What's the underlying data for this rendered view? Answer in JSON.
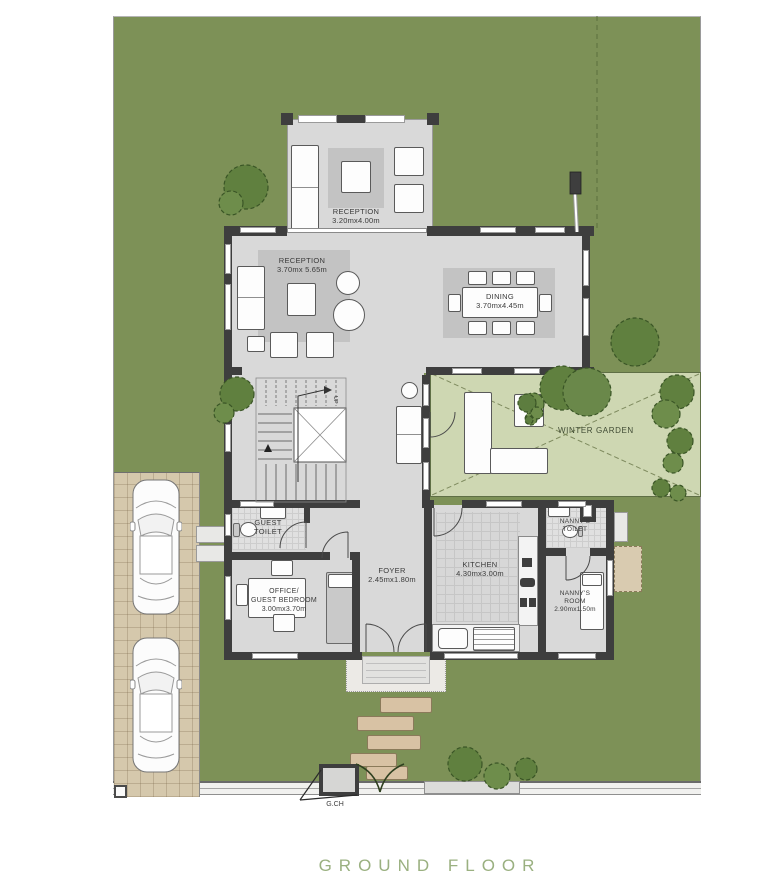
{
  "footer": {
    "title": "GROUND FLOOR"
  },
  "rooms": {
    "reception_terrace": {
      "name": "RECEPTION",
      "size": "3.20mx4.00m"
    },
    "reception_main": {
      "name": "RECEPTION",
      "size": "3.70mx 5.65m"
    },
    "dining": {
      "name": "DINING",
      "size": "3.70mx4.45m"
    },
    "winter_garden": {
      "name": "WINTER GARDEN"
    },
    "guest_toilet": {
      "name": "GUEST\nTOILET"
    },
    "office_guest_bedroom": {
      "name": "OFFICE/\nGUEST BEDROOM",
      "size": "3.00mx3.70m"
    },
    "foyer": {
      "name": "FOYER",
      "size": "2.45mx1.80m"
    },
    "kitchen": {
      "name": "KITCHEN",
      "size": "4.30mx3.00m"
    },
    "nanny_toilet": {
      "name": "NANNY'S\nTOILET"
    },
    "nanny_room": {
      "name": "NANNY'S\nROOM",
      "size": "2.90mx1.50m"
    }
  },
  "annotations": {
    "gate": "G.CH",
    "stairs_direction": "UP"
  },
  "colors": {
    "lawn": "#7d9157",
    "winter_garden": "#ced7b2",
    "wall": "#3e3e3e",
    "floor": "#d9d9d9",
    "rug": "#c3c3c3",
    "driveway": "#d5c8ac",
    "stepping_stone": "#d8c2a4",
    "tree": "#60803f",
    "title_text": "#9ab080"
  }
}
